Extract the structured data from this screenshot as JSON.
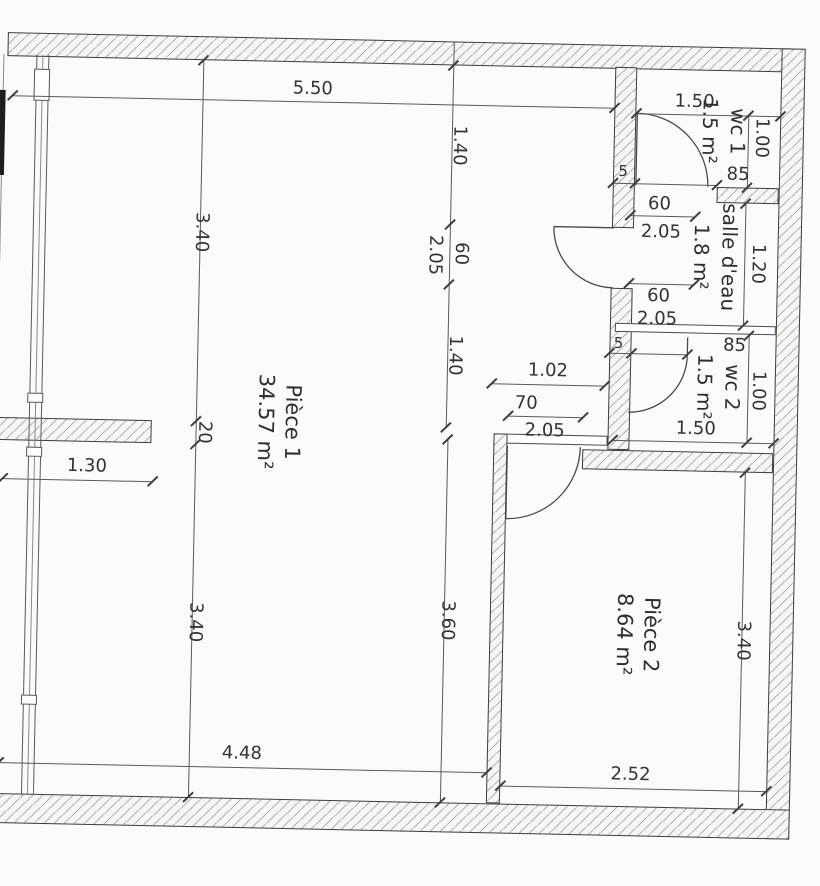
{
  "colors": {
    "ink": "#3a3a3a",
    "hatch_line": "#6e6e6e",
    "paper": "#fbfbfa"
  },
  "rooms": {
    "piece1": {
      "name": "Pièce 1",
      "area": "34.57 m²"
    },
    "piece2": {
      "name": "Pièce 2",
      "area": "8.64 m²"
    },
    "wc1": {
      "name": "wc 1",
      "area": "1.5 m²"
    },
    "salle_eau": {
      "name": "salle d'eau",
      "area": "1.8 m²"
    },
    "wc2": {
      "name": "wc 2",
      "area": "1.5 m²"
    }
  },
  "dims": {
    "d550": "5.50",
    "d340_upper": "3.40",
    "d20": "20",
    "d340_lower": "3.40",
    "d130": "1.30",
    "d140_upper": "1.40",
    "d60_mid": "60",
    "d205_mid": "2.05",
    "d140_lower": "1.40",
    "d360": "3.60",
    "d340_p2": "3.40",
    "d150_wc1": "1.50",
    "d100_wc1": "1.00",
    "d5_wc1": "5",
    "d85_wc1": "85",
    "d60_salle_top": "60",
    "d205_salle_top": "2.05",
    "d120_salle": "1.20",
    "d60_salle_bottom": "60",
    "d205_salle_bottom": "2.05",
    "d5_wc2": "5",
    "d85_wc2": "85",
    "d100_wc2": "1.00",
    "d150_wc2": "1.50",
    "d102": "1.02",
    "d70": "70",
    "d205_p2door": "2.05",
    "d448": "4.48",
    "d252": "2.52"
  }
}
